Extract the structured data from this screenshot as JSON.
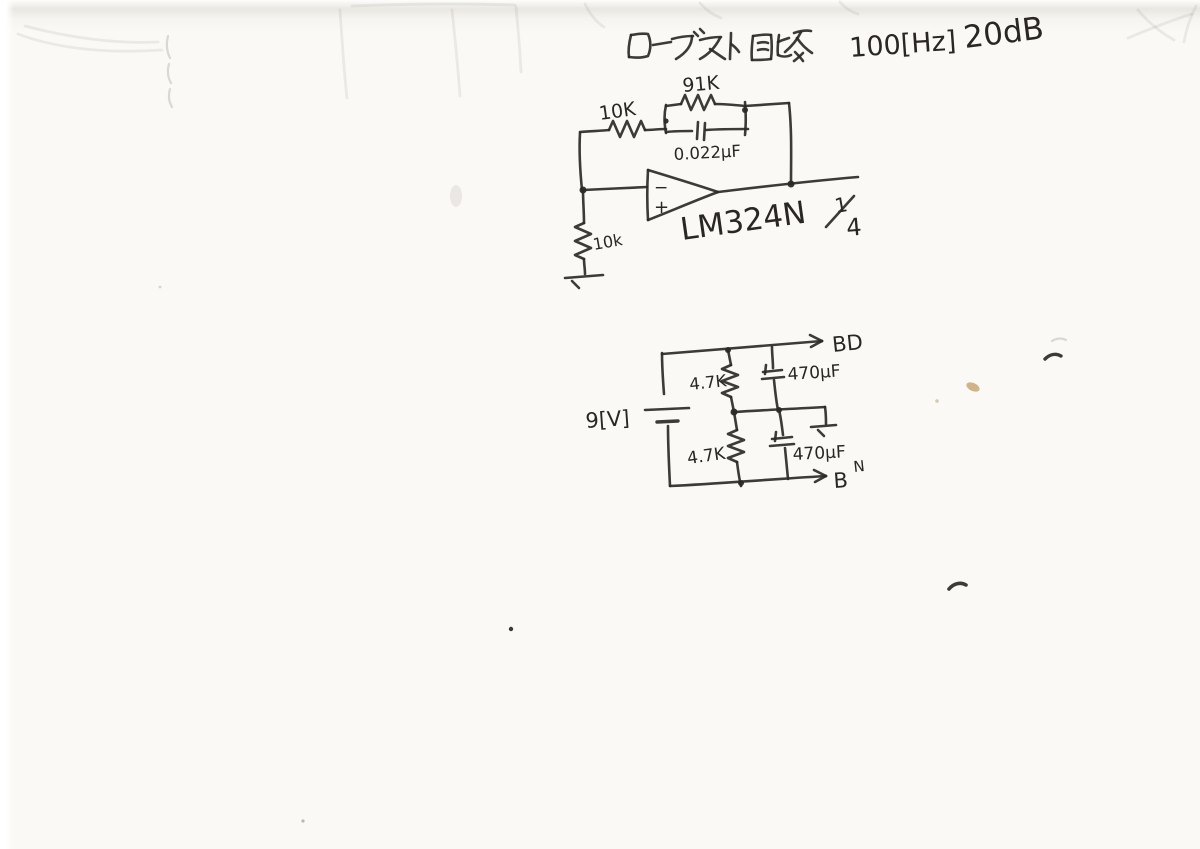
{
  "title": {
    "japanese": "ローブスト回路",
    "frequency": "100[Hz]",
    "gain": "20dB"
  },
  "booster_circuit": {
    "input_resistor": "10K",
    "feedback_resistor": "91K",
    "feedback_capacitor": "0.022µF",
    "ground_resistor": "10k",
    "opamp_part": "LM324N",
    "opamp_fraction_num": "1",
    "opamp_fraction_den": "4",
    "inverting_input": "−",
    "noninverting_input": "+"
  },
  "power_circuit": {
    "battery_voltage": "9[V]",
    "upper_resistor": "4.7K",
    "lower_resistor": "4.7K",
    "upper_capacitor": "470µF",
    "lower_capacitor": "470µF",
    "positive_rail": "BD",
    "negative_rail_b": "B",
    "negative_rail_n": "N"
  }
}
